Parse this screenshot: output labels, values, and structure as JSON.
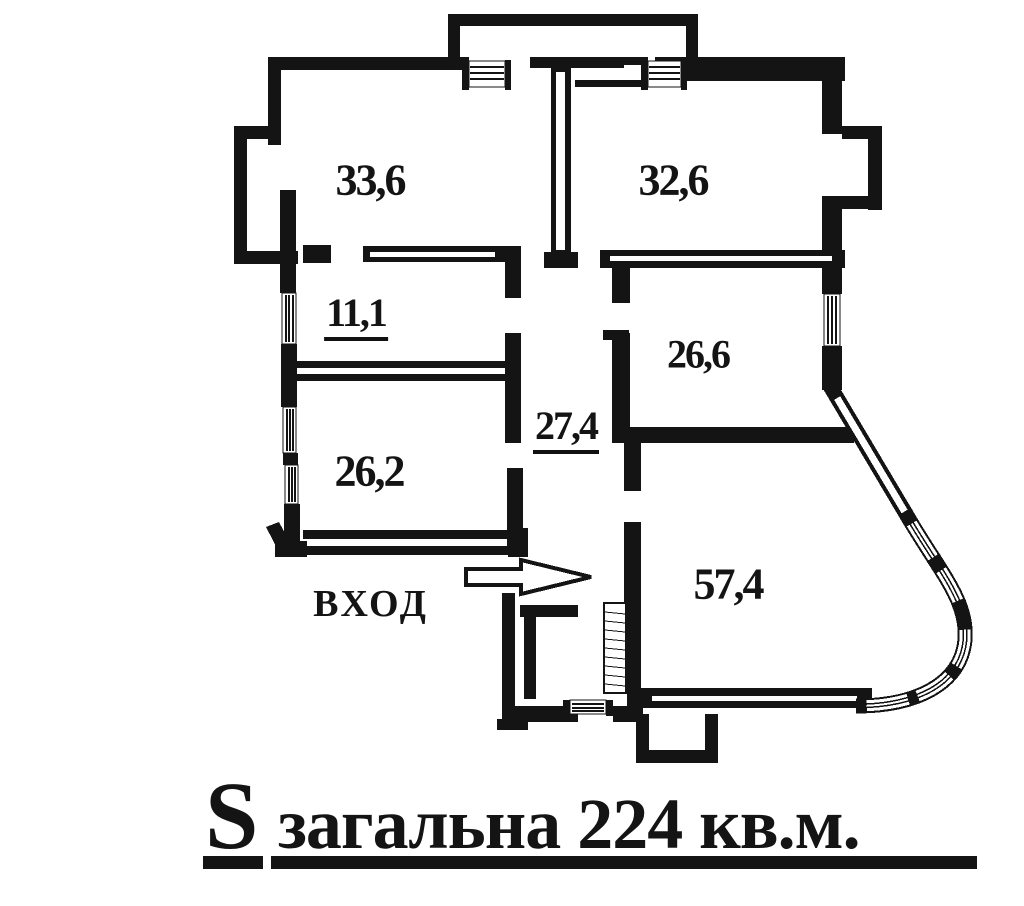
{
  "page": {
    "background": "#ffffff",
    "ink": "#111111",
    "type_label": "apartment floor plan"
  },
  "plan": {
    "rooms": [
      {
        "id": "room-top-left",
        "area_label": "33,6",
        "underlined": false
      },
      {
        "id": "room-top-right",
        "area_label": "32,6",
        "underlined": false
      },
      {
        "id": "room-hall",
        "area_label": "11,1",
        "underlined": true
      },
      {
        "id": "room-mid-right",
        "area_label": "26,6",
        "underlined": false
      },
      {
        "id": "corridor",
        "area_label": "27,4",
        "underlined": true
      },
      {
        "id": "room-mid-left",
        "area_label": "26,2",
        "underlined": false
      },
      {
        "id": "room-bottom-right",
        "area_label": "57,4",
        "underlined": false
      }
    ],
    "entrance": {
      "label": "ВХОД",
      "arrow_icon": "right-arrow"
    },
    "symbols": {
      "window_icon": "hatched-window",
      "stairs_icon": "stairs-hatch"
    }
  },
  "caption": {
    "area_symbol": "S",
    "text": "загальна 224 кв.м.",
    "total_area_sqm": "224"
  }
}
